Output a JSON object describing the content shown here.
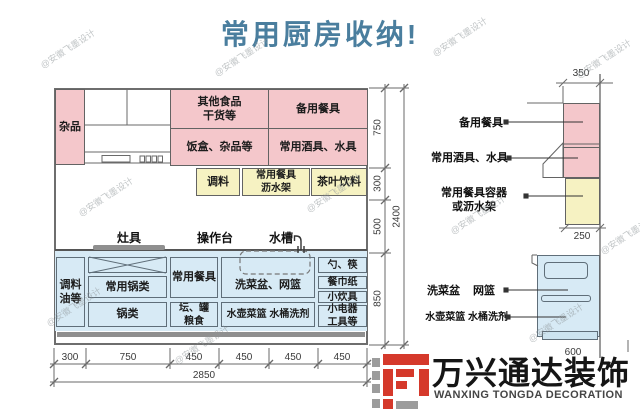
{
  "title": "常用厨房收纳!",
  "watermark": {
    "text": "@安徽飞墨设计"
  },
  "colors": {
    "title_accent": "#4a7e9e",
    "cabinet_pink": "#f4c7cb",
    "cabinet_yellow": "#f6f2c2",
    "cabinet_blue": "#d7eaf5",
    "line": "#636363",
    "logo_red": "#d5392b",
    "logo_gray": "#9c9c9c"
  },
  "elevation": {
    "upper": {
      "misc": "杂品",
      "other_food": "其他食品\n干货等",
      "spare_tableware": "备用餐具",
      "lunch_boxes": "饭盒、杂品等",
      "wine_water": "常用酒具、水具"
    },
    "mid": {
      "seasoning": "调料",
      "drain_rack": "常用餐具\n沥水架",
      "tea": "茶叶饮料"
    },
    "counter": {
      "stove": "灶具",
      "worktop": "操作台",
      "sink": "水槽"
    },
    "base": {
      "oil": "调料\n油等",
      "common_pots": "常用锅类",
      "pots": "锅类",
      "tableware": "常用餐具",
      "jars": "坛、罐\n粮食",
      "sink_basket": "洗菜盆、网篮",
      "kettle": "水壶菜篮 水桶洗剂",
      "spoons": "勺、筷",
      "napkins": "餐巾纸",
      "utensils": "小炊具",
      "small_appliances": "小电器\n工具等"
    },
    "dims": {
      "bottom": [
        "300",
        "750",
        "450",
        "450",
        "450",
        "450"
      ],
      "bottom_total": "2850",
      "right": [
        "750",
        "300",
        "500",
        "850"
      ],
      "right_total": "2400"
    }
  },
  "side_view": {
    "dim_top": "350",
    "dim_mid": "250",
    "dim_bottom": "600",
    "labels": {
      "spare_tableware": "备用餐具",
      "wine_water": "常用酒具、水具",
      "container_rack": "常用餐具容器\n或沥水架",
      "sink": "洗菜盆",
      "basket": "网篮",
      "kettle": "水壶菜篮 水桶洗剂"
    }
  },
  "logo": {
    "name": "万兴通达装饰",
    "sub": "WANXING TONGDA DECORATION"
  }
}
